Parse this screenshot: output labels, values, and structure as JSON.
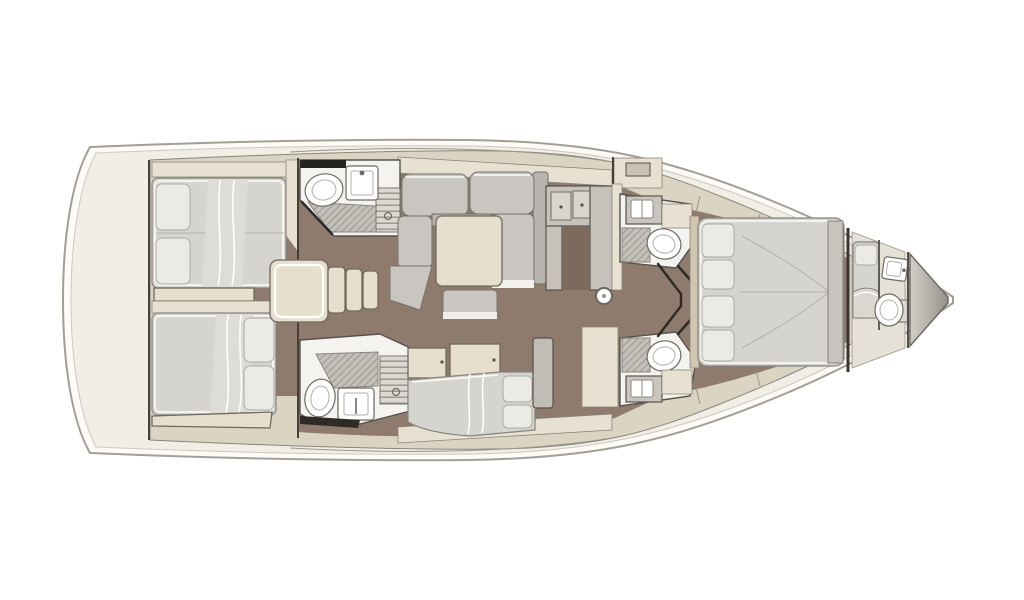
{
  "meta": {
    "title": "Sailing yacht interior layout — top-down deck plan",
    "view": "top-down floor plan",
    "bow_direction": "right",
    "stern_direction": "left",
    "visible_text": "none"
  },
  "palette": {
    "bg": "#ffffff",
    "hull_fill": "#fcfbf8",
    "hull_stroke": "#a39f96",
    "deck": "#f1eee5",
    "structure": "#dcd4c3",
    "structure_light": "#e8e1d2",
    "floor": "#8e7b6e",
    "floor_dark": "#7d6a5e",
    "upholstery": "#c9c6c1",
    "upholstery_dark": "#b7b4ae",
    "linen": "#d6d4cf",
    "pillow": "#eceae5",
    "fixture": "#f4f3ef",
    "table": "#e6dfcd",
    "wood_trim": "#cfc5b0",
    "dark_line": "#2e2b26",
    "locker_grad_from": "#d2cfc9",
    "locker_grad_to": "#95928b"
  },
  "areas": [
    {
      "id": "stern-deck",
      "kind": "deck"
    },
    {
      "id": "aft-cabin-port",
      "kind": "cabin",
      "features": [
        "double-berth",
        "two-pillows",
        "shelf"
      ]
    },
    {
      "id": "aft-cabin-starboard",
      "kind": "cabin",
      "features": [
        "double-berth",
        "two-pillows",
        "bench"
      ]
    },
    {
      "id": "aft-head-port",
      "kind": "bathroom",
      "features": [
        "toilet",
        "sink",
        "shower-grate",
        "slatted-bench"
      ]
    },
    {
      "id": "aft-head-starboard",
      "kind": "bathroom",
      "features": [
        "toilet",
        "sink",
        "shower-grate",
        "slatted-bench"
      ]
    },
    {
      "id": "companionway-steps",
      "kind": "stairs",
      "steps": 3
    },
    {
      "id": "saloon-dinette",
      "kind": "seating",
      "features": [
        "u-shaped-sofa",
        "square-table",
        "ottoman"
      ]
    },
    {
      "id": "galley",
      "kind": "galley",
      "features": [
        "counters",
        "cabinets"
      ]
    },
    {
      "id": "mast-post",
      "kind": "structure"
    },
    {
      "id": "saloon-settee",
      "kind": "seating",
      "features": [
        "daybed",
        "pillows",
        "lockers"
      ]
    },
    {
      "id": "fwd-head-port",
      "kind": "bathroom",
      "features": [
        "sink",
        "shower-grate",
        "toilet"
      ]
    },
    {
      "id": "fwd-head-starboard",
      "kind": "bathroom",
      "features": [
        "sink",
        "shower-grate",
        "toilet"
      ]
    },
    {
      "id": "owners-cabin",
      "kind": "cabin",
      "features": [
        "island-double-berth",
        "four-pillows",
        "wardrobes"
      ]
    },
    {
      "id": "crew-compartment",
      "kind": "cabin",
      "features": [
        "single-berth",
        "sink",
        "toilet"
      ]
    },
    {
      "id": "anchor-locker",
      "kind": "locker"
    },
    {
      "id": "bow-tip",
      "kind": "hull"
    }
  ]
}
